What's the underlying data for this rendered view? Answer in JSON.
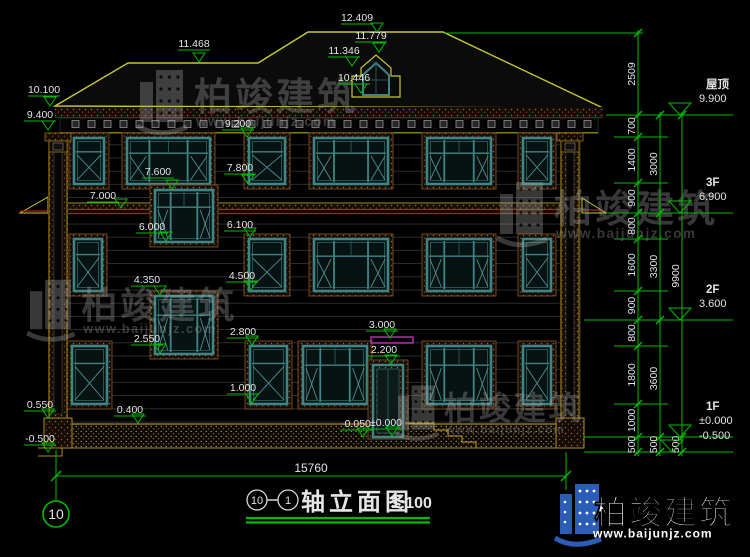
{
  "title": {
    "axis_start": "10",
    "axis_end": "1",
    "text": "轴立面图",
    "scale": "1:100"
  },
  "axis_bubble": {
    "label": "10"
  },
  "bottom_dim": {
    "label": "15760"
  },
  "logo": {
    "brand": "柏竣建筑",
    "url": "www.baijunjz.com"
  },
  "watermark": {
    "brand": "柏竣建筑",
    "url": "www.baijunjz.com",
    "spots": [
      [
        140,
        66,
        1
      ],
      [
        500,
        178,
        1
      ],
      [
        30,
        276,
        0.95
      ],
      [
        398,
        382,
        0.85
      ]
    ]
  },
  "facade_labels": [
    [
      "12.409",
      357,
      12,
      377,
      32
    ],
    [
      "11.779",
      371,
      30,
      379,
      52
    ],
    [
      "11.346",
      344,
      45,
      352,
      66
    ],
    [
      "10.446",
      354,
      72,
      361,
      93
    ],
    [
      "11.468",
      194,
      38,
      199,
      62
    ],
    [
      "10.100",
      44,
      84,
      50,
      106
    ],
    [
      "9.400",
      40,
      109,
      48,
      130
    ],
    [
      "9.200",
      238,
      118,
      247,
      137
    ],
    [
      "7.800",
      240,
      162,
      248,
      184
    ],
    [
      "7.600",
      158,
      166,
      172,
      189
    ],
    [
      "7.000",
      103,
      190,
      121,
      208
    ],
    [
      "6.100",
      240,
      219,
      250,
      237
    ],
    [
      "6.000",
      152,
      221,
      166,
      241
    ],
    [
      "4.500",
      242,
      270,
      251,
      290
    ],
    [
      "4.350",
      147,
      274,
      160,
      295
    ],
    [
      "3.000",
      382,
      319,
      390,
      338
    ],
    [
      "2.800",
      243,
      326,
      252,
      345
    ],
    [
      "2.550",
      147,
      333,
      160,
      353
    ],
    [
      "2.200",
      384,
      344,
      391,
      364
    ],
    [
      "1.000",
      243,
      382,
      252,
      403
    ],
    [
      "0.550",
      40,
      399,
      48,
      418
    ],
    [
      "0.400",
      130,
      404,
      138,
      423
    ],
    [
      "-0.050",
      356,
      418,
      363,
      437
    ],
    [
      "±0.000",
      386,
      417,
      392,
      436
    ],
    [
      "-0.500",
      40,
      433,
      48,
      452
    ]
  ],
  "right_chains": [
    {
      "x": 638,
      "segments": [
        [
          "2509",
          33,
          115
        ],
        [
          "700",
          115,
          137
        ],
        [
          "1400",
          137,
          183
        ],
        [
          "900",
          183,
          213
        ],
        [
          "800",
          213,
          239
        ],
        [
          "1600",
          239,
          291
        ],
        [
          "900",
          291,
          320
        ],
        [
          "800",
          320,
          346
        ],
        [
          "1800",
          346,
          404
        ],
        [
          "1000",
          404,
          437
        ],
        [
          "500",
          437,
          452
        ]
      ]
    },
    {
      "x": 660,
      "segments": [
        [
          "3000",
          115,
          213
        ],
        [
          "3300",
          213,
          320
        ],
        [
          "3600",
          320,
          437
        ],
        [
          "500",
          437,
          452
        ]
      ]
    },
    {
      "x": 682,
      "segments": [
        [
          "9900",
          115,
          437
        ],
        [
          "500",
          437,
          452
        ]
      ]
    }
  ],
  "ext_lines": [
    [
      33,
      445,
      643
    ],
    [
      115,
      606,
      733
    ],
    [
      137,
      614,
      668
    ],
    [
      183,
      614,
      668
    ],
    [
      213,
      606,
      733
    ],
    [
      239,
      614,
      668
    ],
    [
      291,
      614,
      668
    ],
    [
      320,
      584,
      733
    ],
    [
      346,
      614,
      668
    ],
    [
      404,
      614,
      668
    ],
    [
      437,
      584,
      733
    ],
    [
      452,
      584,
      733
    ]
  ],
  "levels": [
    {
      "name": "屋顶",
      "value": "9.900",
      "y": 115,
      "tip": 680
    },
    {
      "name": "3F",
      "value": "6.900",
      "y": 213,
      "tip": 680
    },
    {
      "name": "2F",
      "value": "3.600",
      "y": 320,
      "tip": 680
    },
    {
      "name": "1F",
      "value": "±0.000",
      "y": 437,
      "tip": 680
    },
    {
      "name": "",
      "value": "-0.500",
      "y": 452,
      "tip": 672
    }
  ],
  "windows": [
    {
      "x": 74,
      "y": 138,
      "w": 30,
      "h": 46,
      "type": "narrow"
    },
    {
      "x": 127,
      "y": 138,
      "w": 83,
      "h": 46,
      "type": "large"
    },
    {
      "x": 249,
      "y": 138,
      "w": 36,
      "h": 46,
      "type": "narrow"
    },
    {
      "x": 314,
      "y": 138,
      "w": 74,
      "h": 46,
      "type": "large"
    },
    {
      "x": 427,
      "y": 138,
      "w": 64,
      "h": 46,
      "type": "large"
    },
    {
      "x": 523,
      "y": 138,
      "w": 28,
      "h": 46,
      "type": "narrow"
    },
    {
      "x": 155,
      "y": 190,
      "w": 58,
      "h": 52,
      "type": "large"
    },
    {
      "x": 155,
      "y": 296,
      "w": 58,
      "h": 58,
      "type": "large"
    },
    {
      "x": 74,
      "y": 239,
      "w": 28,
      "h": 52,
      "type": "narrow"
    },
    {
      "x": 249,
      "y": 239,
      "w": 36,
      "h": 52,
      "type": "narrow"
    },
    {
      "x": 314,
      "y": 239,
      "w": 74,
      "h": 52,
      "type": "large"
    },
    {
      "x": 427,
      "y": 239,
      "w": 64,
      "h": 52,
      "type": "large"
    },
    {
      "x": 523,
      "y": 239,
      "w": 28,
      "h": 52,
      "type": "narrow"
    },
    {
      "x": 72,
      "y": 346,
      "w": 35,
      "h": 58,
      "type": "narrow"
    },
    {
      "x": 250,
      "y": 346,
      "w": 37,
      "h": 58,
      "type": "narrow"
    },
    {
      "x": 303,
      "y": 346,
      "w": 64,
      "h": 58,
      "type": "large"
    },
    {
      "x": 427,
      "y": 346,
      "w": 64,
      "h": 58,
      "type": "large"
    },
    {
      "x": 523,
      "y": 346,
      "w": 28,
      "h": 58,
      "type": "narrow"
    }
  ]
}
